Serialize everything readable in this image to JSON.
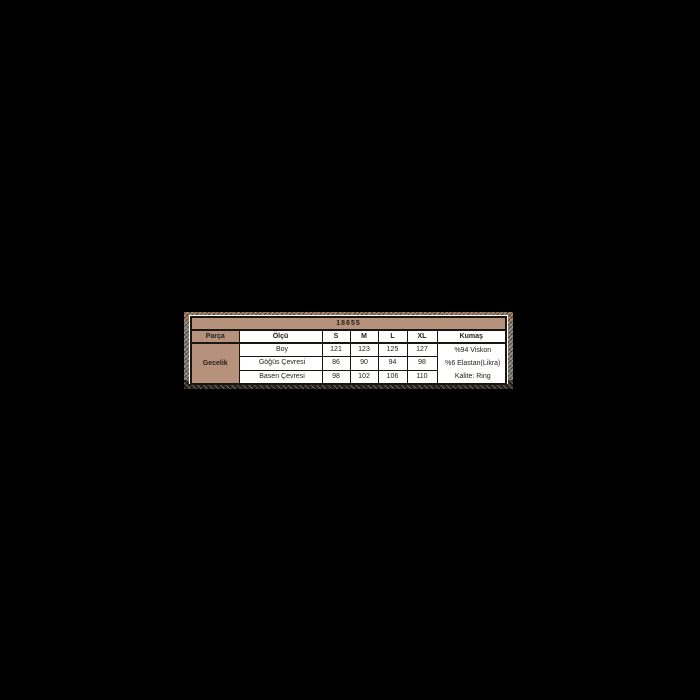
{
  "page": {
    "background": "#000000"
  },
  "size_chart": {
    "model_code": "18655",
    "headers": {
      "part": "Parça",
      "measure": "Ölçü",
      "s": "S",
      "m": "M",
      "l": "L",
      "xl": "XL",
      "fabric": "Kumaş"
    },
    "part_label": "Gecelik",
    "rows": [
      {
        "label": "Boy",
        "s": "121",
        "m": "123",
        "l": "125",
        "xl": "127"
      },
      {
        "label": "Göğüs Çevresi",
        "s": "86",
        "m": "90",
        "l": "94",
        "xl": "98"
      },
      {
        "label": "Basen Çevresi",
        "s": "98",
        "m": "102",
        "l": "106",
        "xl": "110"
      }
    ],
    "fabric_lines": [
      "%94 Viskon",
      "%6 Elastan(Likra)",
      "Kalite: Ring"
    ],
    "colors": {
      "page_bg": "#000000",
      "cell_tan": "#b6927c",
      "table_bg": "#ffffff",
      "border": "#1a1511"
    }
  },
  "chart_data": {
    "type": "table",
    "title": "18655",
    "columns": [
      "Parça",
      "Ölçü",
      "S",
      "M",
      "L",
      "XL",
      "Kumaş"
    ],
    "rows": [
      [
        "Gecelik",
        "Boy",
        121,
        123,
        125,
        127,
        "%94 Viskon"
      ],
      [
        "Gecelik",
        "Göğüs Çevresi",
        86,
        90,
        94,
        98,
        "%6 Elastan(Likra)"
      ],
      [
        "Gecelik",
        "Basen Çevresi",
        98,
        102,
        106,
        110,
        "Kalite: Ring"
      ]
    ],
    "layout": {
      "position": "centered",
      "background": "black",
      "frame": "speckled-tan"
    }
  }
}
